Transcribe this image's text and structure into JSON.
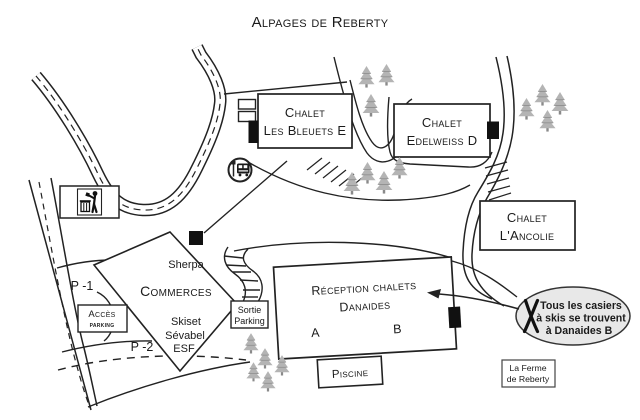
{
  "title": "Alpages de Reberty",
  "map": {
    "chalets": {
      "bleuets": {
        "line1": "Chalet",
        "line2": "Les Bleuets E"
      },
      "edelweiss": {
        "line1": "Chalet",
        "line2": "Edelweiss D"
      },
      "ancolie": {
        "line1": "Chalet",
        "line2": "L'Ancolie"
      }
    },
    "reception": {
      "line1": "Réception chalets",
      "line2": "Danaides",
      "unit_a": "A",
      "unit_b": "B"
    },
    "piscine": {
      "label": "Piscine"
    },
    "ferme": {
      "line1": "La Ferme",
      "line2": "de Reberty"
    },
    "commerces": {
      "title": "Commerces",
      "shops": [
        "Sherpa",
        "Skiset",
        "Sévabel",
        "ESF"
      ]
    },
    "parking": {
      "access": {
        "line1": "Accès",
        "line2": "parking"
      },
      "exit": {
        "line1": "Sortie",
        "line2": "Parking"
      },
      "level_1": "P -1",
      "level_2": "P -2"
    },
    "callout": {
      "line1": "Tous les casiers",
      "line2": "à skis se trouvent",
      "line3": "à Danaides B"
    }
  },
  "icons": {
    "bus_stop": "bus-stop-icon",
    "trash": "trash-disposal-icon",
    "skis": "crossed-skis-icon",
    "tree": "fir-tree-icon"
  },
  "colors": {
    "ink": "#1a1a1a",
    "outline": "#222222",
    "tree_fill": "#b4b4b4",
    "tree_dark": "#8a8a8a",
    "callout_fill": "#e8e8e8",
    "background": "#ffffff"
  }
}
